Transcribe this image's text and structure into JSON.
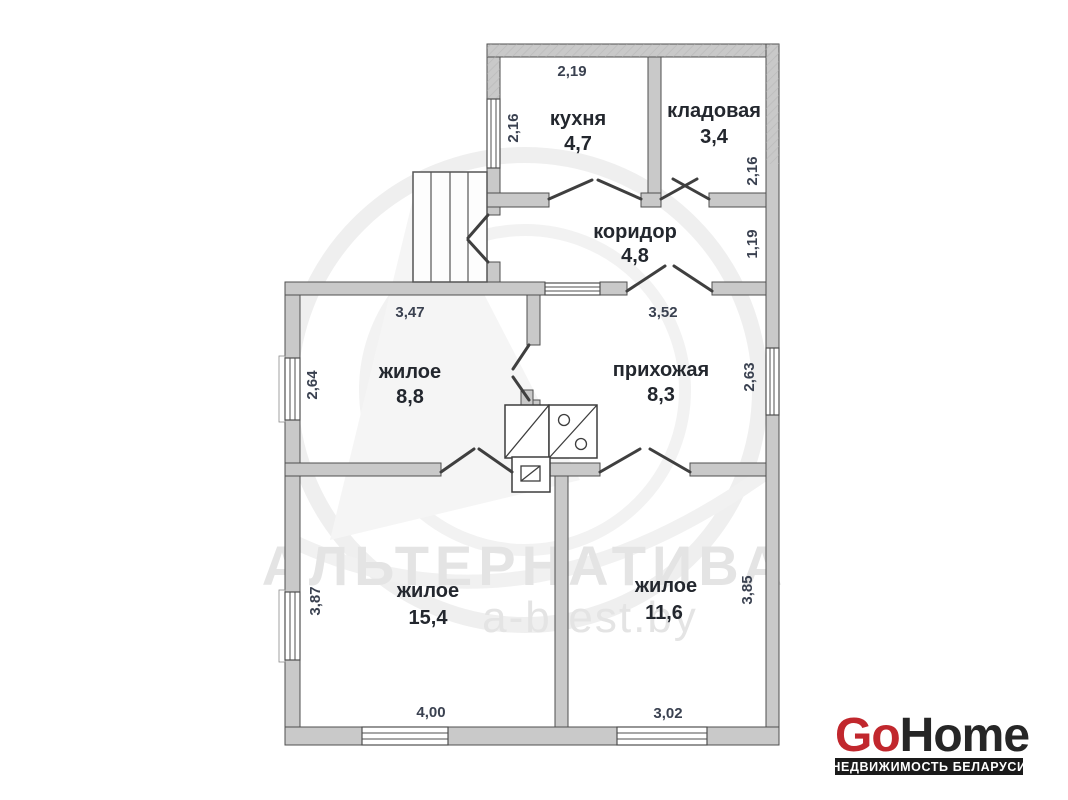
{
  "floor_plan": {
    "rooms": {
      "kitchen": {
        "name": "кухня",
        "area": "4,7",
        "width_m": "2,19",
        "height_m": "2,16"
      },
      "pantry": {
        "name": "кладовая",
        "area": "3,4",
        "height_m": "2,16"
      },
      "corridor": {
        "name": "коридор",
        "area": "4,8",
        "height_m": "1,19"
      },
      "living_small": {
        "name": "жилое",
        "area": "8,8",
        "width_m": "3,47",
        "height_m": "2,64"
      },
      "hallway": {
        "name": "прихожая",
        "area": "8,3",
        "width_m": "3,52",
        "height_m": "2,63"
      },
      "living_large": {
        "name": "жилое",
        "area": "15,4",
        "width_m": "4,00",
        "height_m": "3,87"
      },
      "living_medium": {
        "name": "жилое",
        "area": "11,6",
        "width_m": "3,02",
        "height_m": "3,85"
      }
    },
    "colors": {
      "wall_fill": "#c9c9c9",
      "wall_stroke": "#4f4f4f",
      "dim_text": "#3a4150",
      "room_text": "#23272e"
    }
  },
  "watermark": {
    "agency": "АЛЬТЕРНАТИВА",
    "website": "a-brest.by",
    "color": "#e4e4e4"
  },
  "logo": {
    "go": "Go",
    "home": "Home",
    "tagline": "НЕДВИЖИМОСТЬ БЕЛАРУСИ",
    "go_color": "#c1272d",
    "home_color": "#262626",
    "tagline_bg": "#1a1a1a",
    "tagline_color": "#ffffff"
  }
}
